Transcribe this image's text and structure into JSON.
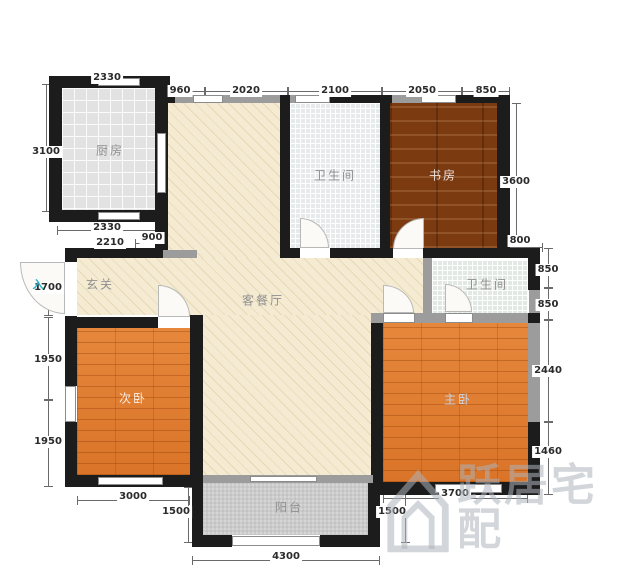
{
  "rooms": {
    "kitchen": "厨房",
    "bath_top": "卫生间",
    "study": "书房",
    "hall": "玄关",
    "living": "客餐厅",
    "bath_right": "卫生间",
    "bed_second": "次卧",
    "bed_master": "主卧",
    "balcony": "阳台"
  },
  "dims": {
    "top_kitchen_2330": "2330",
    "top_960": "960",
    "top_2020": "2020",
    "top_2100": "2100",
    "top_2050": "2050",
    "top_850": "850",
    "left_3100": "3100",
    "below_kitchen_2330": "2330",
    "below_kitchen_900": "900",
    "below_kitchen_2210": "2210",
    "left_1700": "1700",
    "left_1950_a": "1950",
    "left_1950_b": "1950",
    "bottom_3000": "3000",
    "bottom_1500_left": "1500",
    "bottom_4300": "4300",
    "bottom_1500_right": "1500",
    "bottom_3700": "3700",
    "right_3600": "3600",
    "right_800": "800",
    "right_850_a": "850",
    "right_850_b": "850",
    "right_2440": "2440",
    "right_1460": "1460"
  },
  "marks": {
    "entry_arrow": "入"
  },
  "watermark": {
    "text": "跃居宅配"
  },
  "colors": {
    "wall": "#1c1c1c",
    "wood_floor": "#e0792c",
    "study_floor": "#7c3a11",
    "living_floor": "#f4ebd2",
    "entry_accent": "#27b5cd",
    "watermark_gray": "#adb3ba"
  }
}
